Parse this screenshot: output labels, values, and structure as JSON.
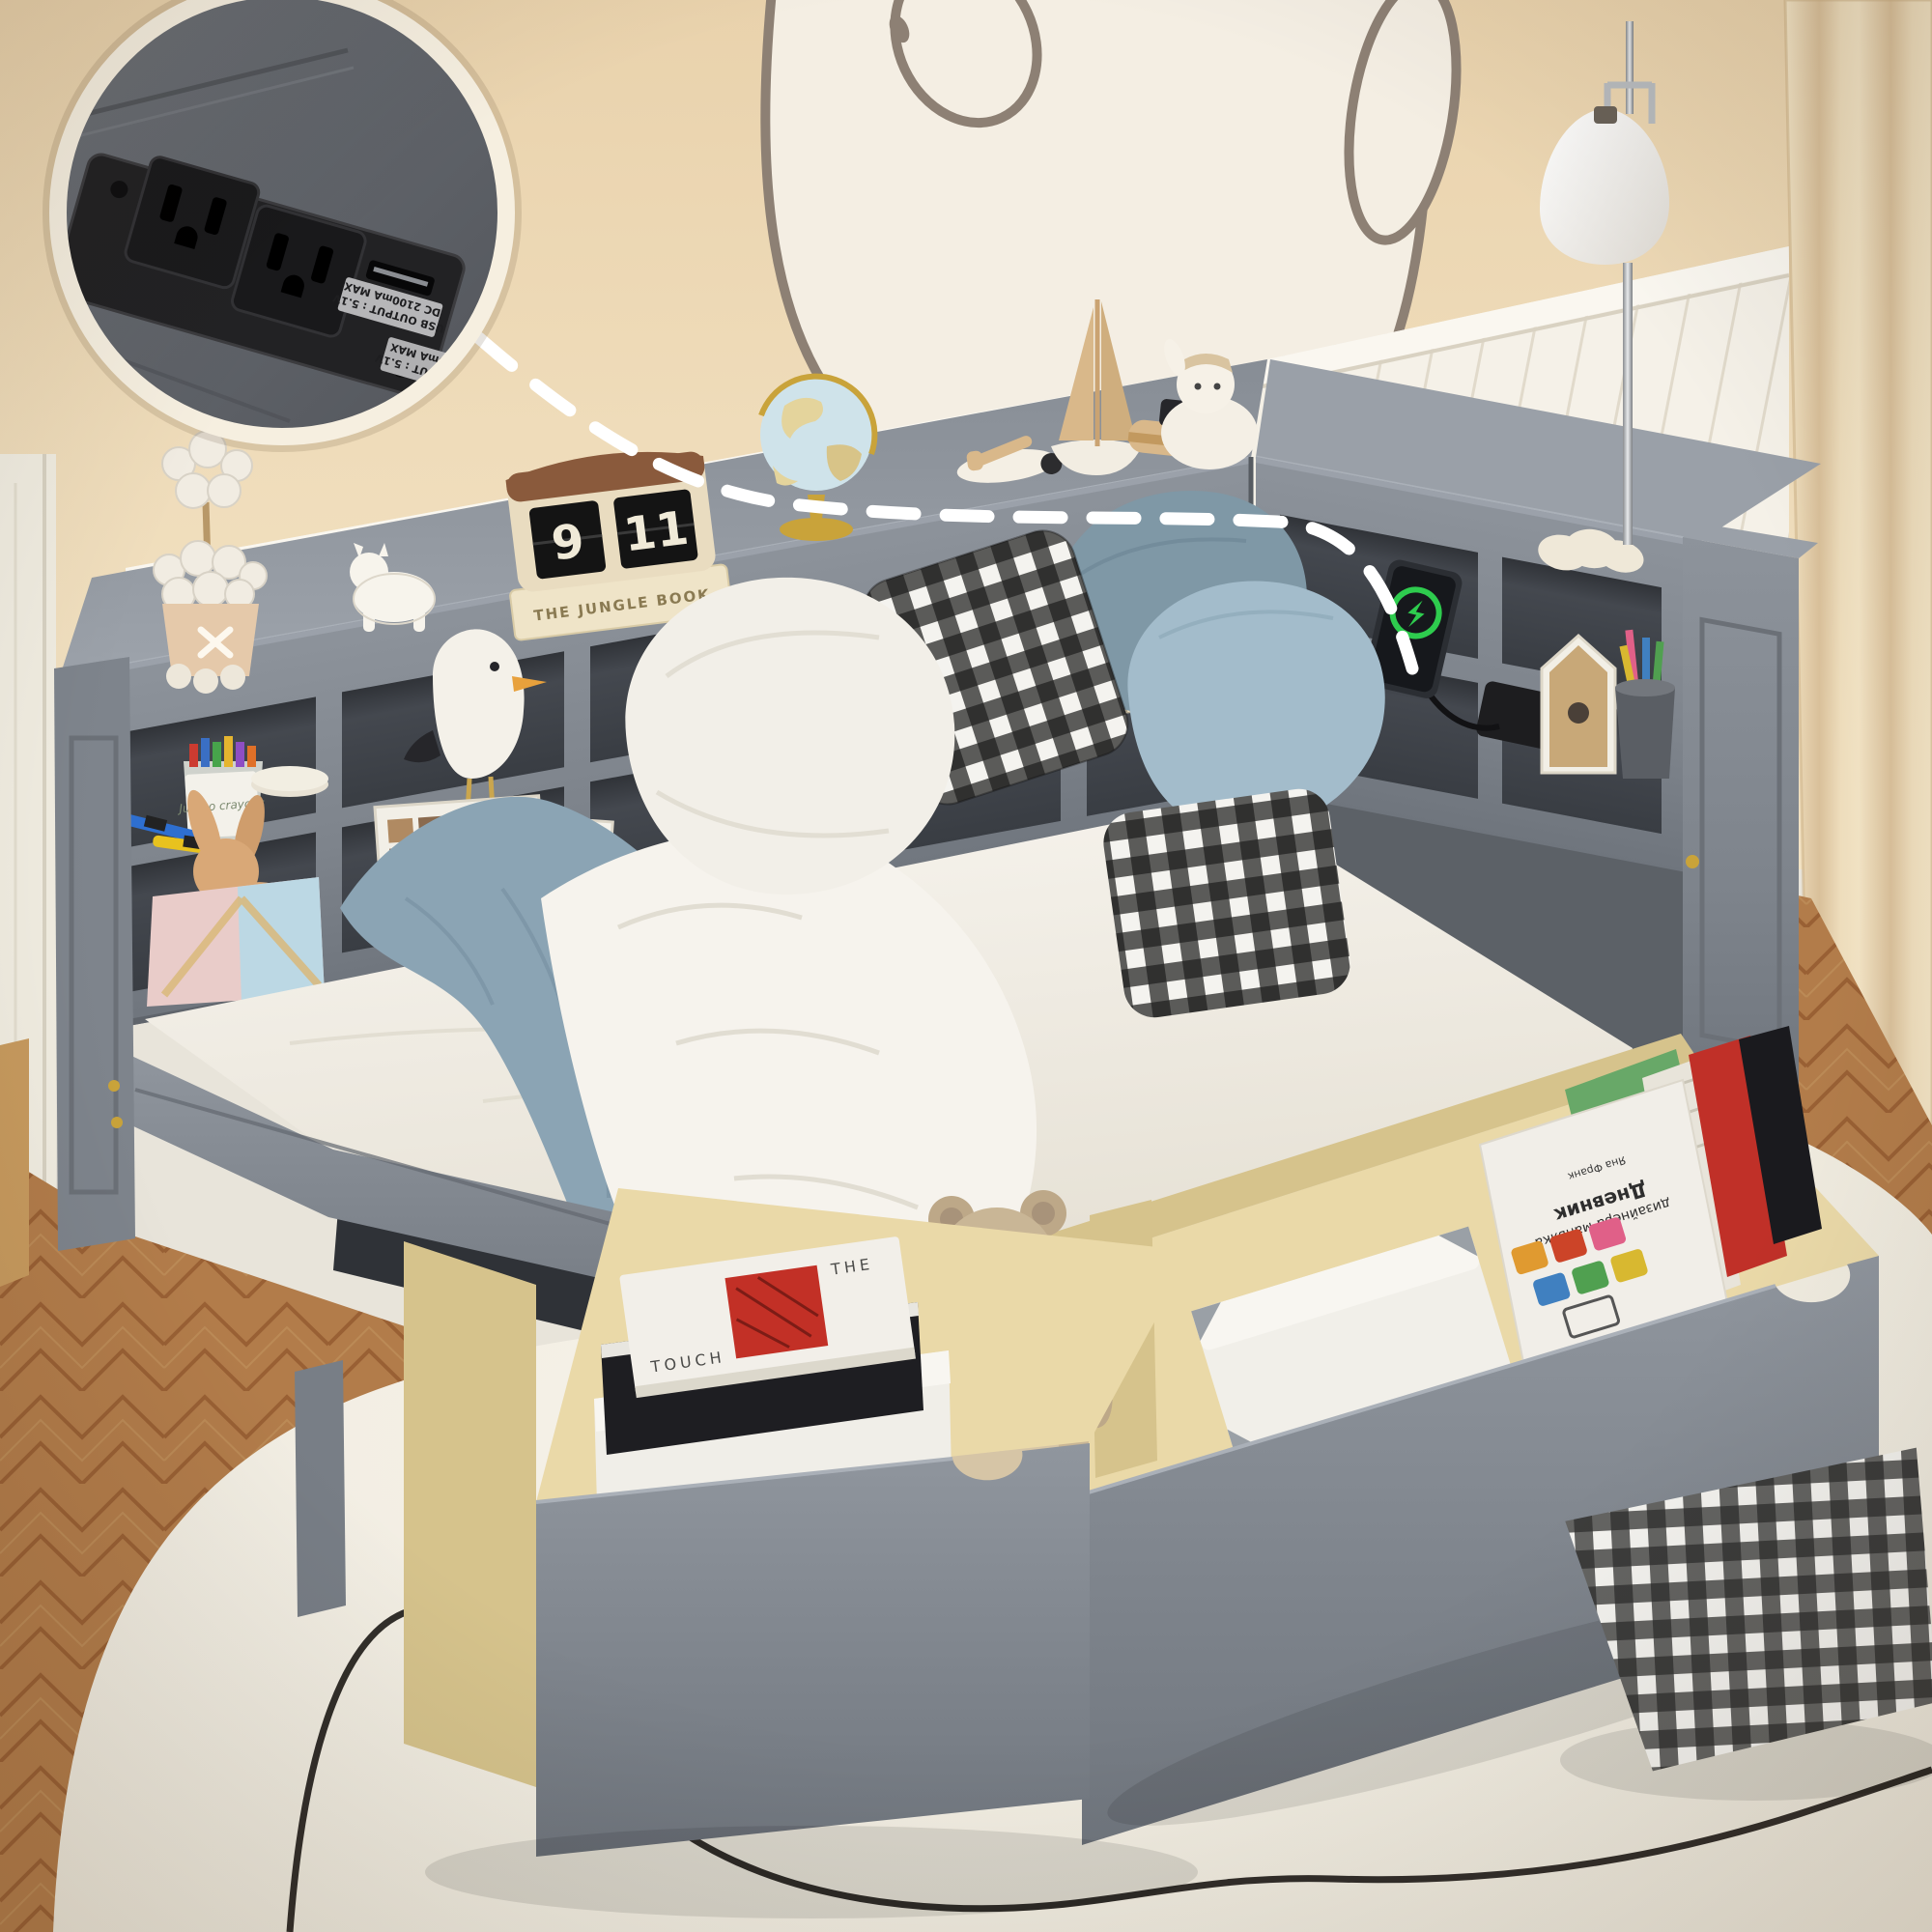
{
  "image": {
    "domain": "natural-image",
    "subject": "Gray kids daybed with L-shaped bookcase cubbies, built-in charging station with USB, and two pull-out under-bed storage drawers",
    "room": "children's bedroom with bear wall mural, white wainscoting, beige walls, floor lamp, herringbone wood floor and cream rug"
  },
  "palette": {
    "wall": "#ecd7b6",
    "wainscot": "#f4f0e6",
    "bed_gray": "#848a92",
    "cubby_dark": "#42464d",
    "mattress": "#f4f1ea",
    "blanket_blue": "#8fa8b8",
    "drawer_wood": "#e9d8a6",
    "rug": "#f3efe5",
    "floor_wood": "#b27c4a",
    "charging_green": "#2ecc4e",
    "station_black": "#1d1d1f",
    "callout_ring": "#f6efe0"
  },
  "callout": {
    "description": "zoom detail of built-in power strip with two AC outlets and two USB ports",
    "labels": {
      "usb_top_line1": "USB OUTPUT : 5.1V",
      "usb_top_line2": "DC 2100mA MAX",
      "usb_bottom_line1": "USB OUTPUT : 5.1V",
      "usb_bottom_line2": "DC 900mA MAX"
    }
  },
  "flip_clock": {
    "hour": "9",
    "minute": "11"
  },
  "decor_text": {
    "jungle_book_cover": "THE JUNGLE BOOK",
    "jungle_book_spine": "THE JUNGLE BOOK",
    "sweet_day_spine": "Sweet day and friends",
    "get_out_spine": "GET OUT",
    "neues_spine": "NEUES BAUEN FELIX GESTINTEN",
    "crayon_tub_label": "Jumbo crayons",
    "touch_book_line1": "THE",
    "touch_book_line2": "TOUCH",
    "designer_diary_author": "Яна Франк",
    "designer_diary_line1": "Дневник",
    "designer_diary_line2": "дизайнера-маньяка"
  }
}
